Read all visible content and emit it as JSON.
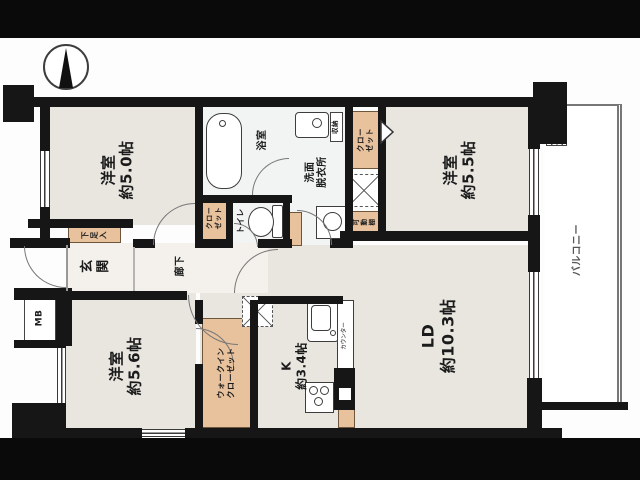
{
  "plan": {
    "rooms": {
      "bedroom_nw": "洋室\n約5.0帖",
      "bedroom_ne": "洋室\n約5.5帖",
      "bedroom_sw": "洋室\n約5.6帖",
      "living_dining": "LD\n約10.3帖",
      "kitchen": "K\n約3.4帖",
      "entrance": "玄\n関",
      "corridor": "廊下",
      "bathroom": "浴室",
      "washroom": "洗面\n脱衣所",
      "toilet": "トイレ",
      "balcony": "バルコニー"
    },
    "storage": {
      "shoe_cabinet": "下\n足\n入",
      "closet_nw": "クロー\nゼット",
      "closet_ne": "クロー\nゼット",
      "walk_in_closet": "ウォークイン\nクローゼット",
      "movable_shelf": "可\n動\n棚",
      "storage_small": "収納"
    },
    "labels": {
      "meter_box": "MB",
      "counter": "カウンター"
    },
    "icons": {
      "compass": "north-arrow-icon",
      "bathtub": "bathtub-icon",
      "toilet": "toilet-icon",
      "washbasin": "washbasin-icon",
      "washing_machine": "washing-machine-icon",
      "kitchen_sink": "kitchen-sink-icon",
      "stove": "stove-icon",
      "pipe_space": "hatched-pipe-space"
    },
    "colors": {
      "wall": "#161616",
      "room_floor": "#e9e6e0",
      "wet_area": "#f2f4f4",
      "storage_orange": "#e7c29d",
      "background": "#0a0a0a"
    }
  }
}
